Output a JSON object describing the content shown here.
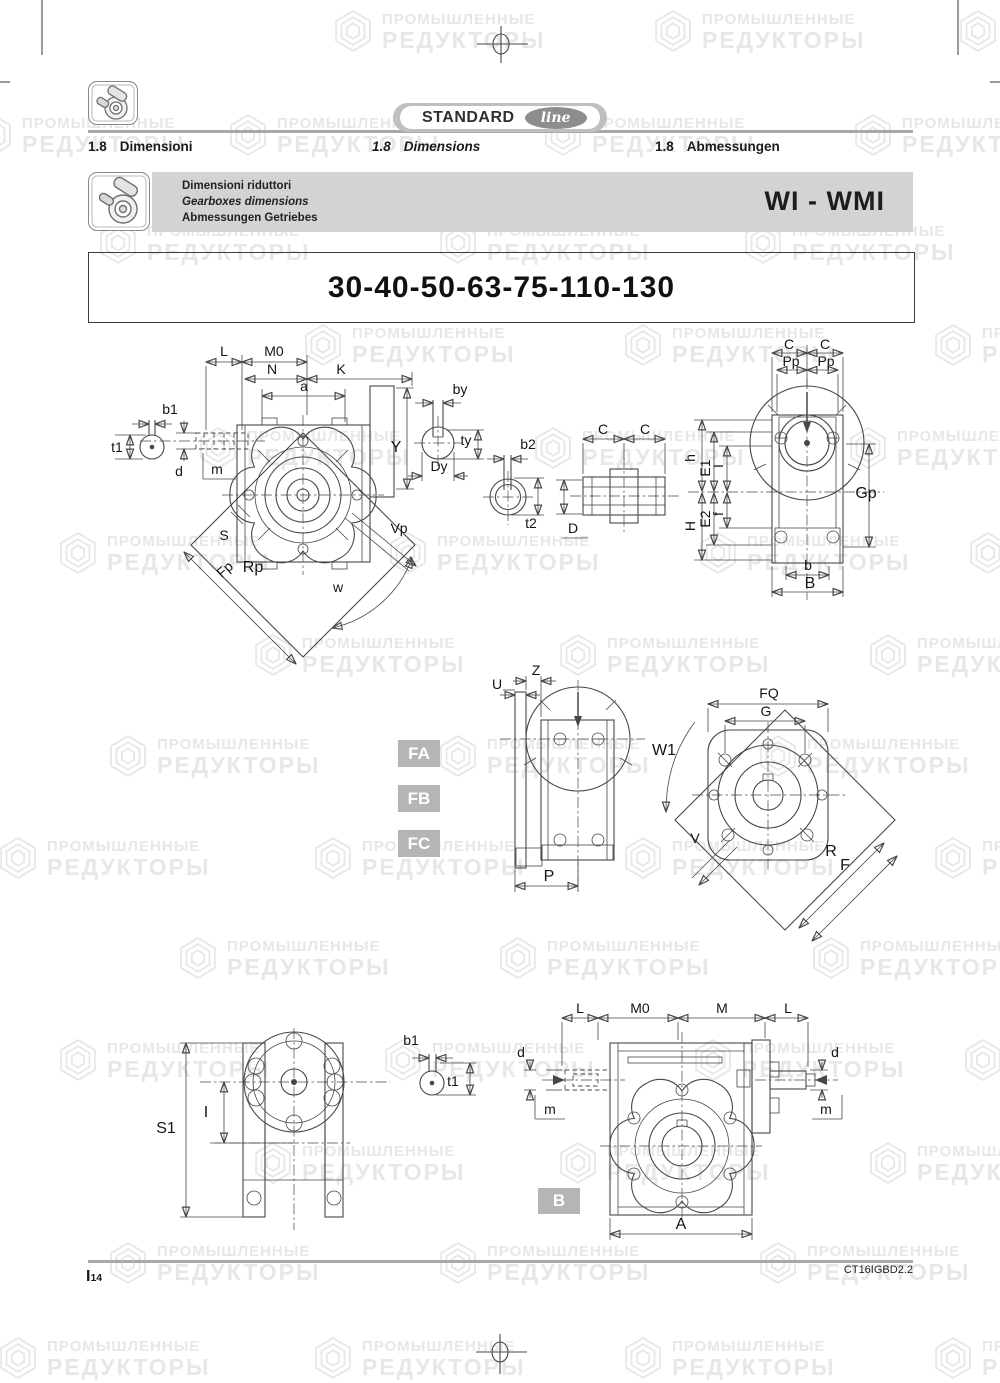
{
  "watermark": {
    "line1": "ПРОМЫШЛЕННЫЕ",
    "line2": "РЕДУКТОРЫ"
  },
  "header": {
    "brand": {
      "standard": "STANDARD",
      "line": "line"
    },
    "sections": [
      {
        "num": "1.8",
        "label": "Dimensioni"
      },
      {
        "num": "1.8",
        "label": "Dimensions"
      },
      {
        "num": "1.8",
        "label": "Abmessungen"
      }
    ],
    "banner": {
      "line_it": "Dimensioni riduttori",
      "line_en": "Gearboxes dimensions",
      "line_de": "Abmessungen Getriebes",
      "model": "WI - WMI"
    },
    "title": "30-40-50-63-75-110-130"
  },
  "badges": {
    "fa": "FA",
    "fb": "FB",
    "fc": "FC",
    "b": "B"
  },
  "labels": {
    "d1": {
      "L": "L",
      "M0": "M0",
      "N": "N",
      "K": "K",
      "a": "a",
      "b1": "b1",
      "t1": "t1",
      "d": "d",
      "m": "m",
      "Y": "Y",
      "S": "S",
      "Fp": "Fp",
      "Rp": "Rp",
      "w": "w",
      "Vp": "Vp"
    },
    "d2": {
      "by": "by",
      "ty": "ty",
      "Dy": "Dy"
    },
    "d3": {
      "b2": "b2",
      "t2": "t2"
    },
    "d4": {
      "C1": "C",
      "C2": "C",
      "D": "D"
    },
    "d5": {
      "C1": "C",
      "C2": "C",
      "Pp1": "Pp",
      "Pp2": "Pp",
      "h": "h",
      "E1": "E1",
      "I": "I",
      "E2": "E2",
      "H": "H",
      "f": "f",
      "Gp": "Gp",
      "b": "b",
      "B": "B"
    },
    "d6": {
      "Z": "Z",
      "U": "U",
      "P": "P"
    },
    "d7": {
      "W1": "W1",
      "FQ": "FQ",
      "G": "G",
      "V": "V",
      "R": "R",
      "F": "F"
    },
    "d8": {
      "S1": "S1",
      "I": "I",
      "b1": "b1",
      "t1": "t1"
    },
    "d9": {
      "L1": "L",
      "M0": "M0",
      "M": "M",
      "L2": "L",
      "d1": "d",
      "d2": "d",
      "m1": "m",
      "m2": "m",
      "A": "A"
    }
  },
  "footer": {
    "page_code": "I",
    "page_num": "14",
    "doc_code": "CT16IGBD2.2"
  }
}
